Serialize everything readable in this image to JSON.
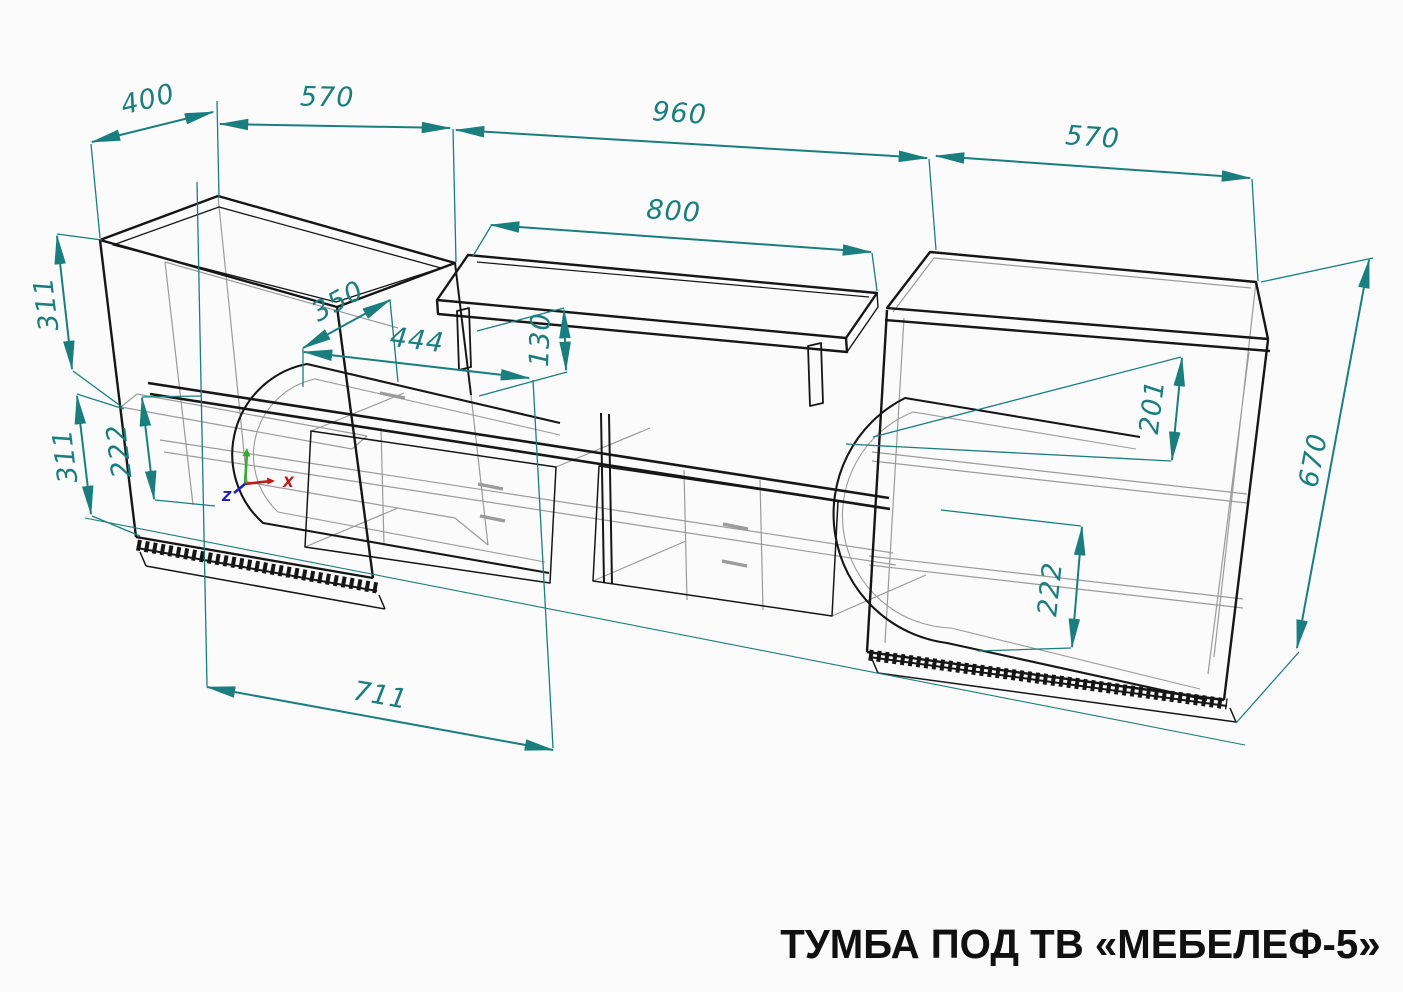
{
  "title": "ТУМБА ПОД ТВ «МЕБЕЛЕФ-5»",
  "axis": {
    "x": "X",
    "z": "Z"
  },
  "dims": {
    "depth_left": "400",
    "width_left": "570",
    "width_center": "960",
    "width_right": "570",
    "shelf_width": "800",
    "shelf_height": "130",
    "shelf_depth": "350",
    "niche_width": "444",
    "left_upper_height": "311",
    "left_lower_height": "311",
    "left_door_height": "222",
    "right_niche_height": "201",
    "cabinet_height": "670",
    "right_door_height": "222",
    "door_width": "711"
  },
  "colors": {
    "dimension": "#1B7E7E",
    "edge": "#141414",
    "hidden": "#9B9B9B",
    "axis_x": "#BF1B1B",
    "axis_y": "#2FAE2F",
    "axis_z": "#1B1BBF",
    "background": "#FBFBFB"
  }
}
